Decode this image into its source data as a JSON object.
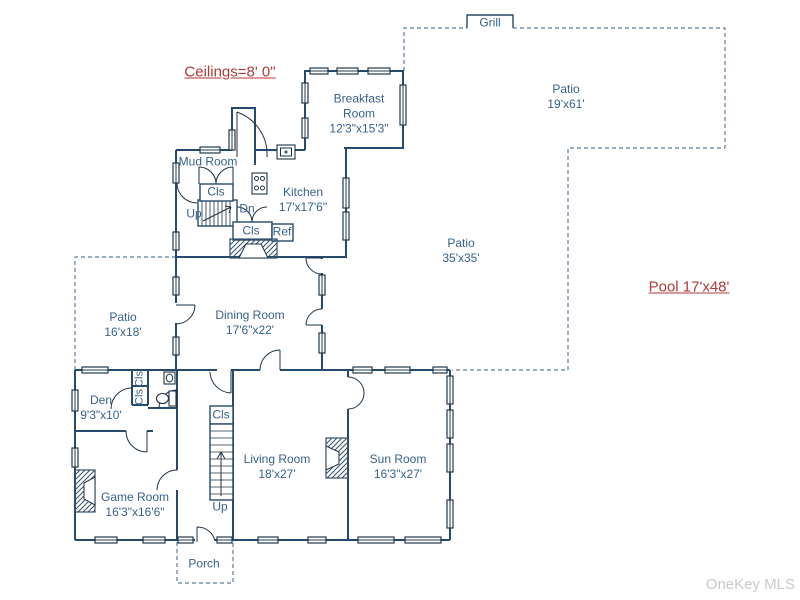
{
  "annotations": {
    "ceilings": "Ceilings=8' 0\"",
    "pool": "Pool 17'x48'"
  },
  "watermark": "OneKey MLS",
  "outdoor": {
    "grill": "Grill",
    "patio_upper": {
      "name": "Patio",
      "dims": "19'x61'"
    },
    "patio_courtyard": {
      "name": "Patio",
      "dims": "35'x35'"
    },
    "patio_side": {
      "name": "Patio",
      "dims": "16'x18'"
    },
    "porch": "Porch"
  },
  "rooms": {
    "breakfast": {
      "name_line1": "Breakfast",
      "name_line2": "Room",
      "dims": "12'3\"x15'3\""
    },
    "kitchen": {
      "name": "Kitchen",
      "dims": "17'x17'6\""
    },
    "mud": {
      "name": "Mud Room"
    },
    "dining": {
      "name": "Dining Room",
      "dims": "17'6\"x22'"
    },
    "den": {
      "name": "Den",
      "dims": "9'3\"x10'"
    },
    "game": {
      "name": "Game Room",
      "dims": "16'3\"x16'6\""
    },
    "living": {
      "name": "Living Room",
      "dims": "18'x27'"
    },
    "sun": {
      "name": "Sun Room",
      "dims": "16'3\"x27'"
    }
  },
  "fixtures": {
    "cls": "Cls",
    "ref": "Ref",
    "up": "Up",
    "dn": "Dn"
  },
  "colors": {
    "wall": "#264a6b",
    "label": "#39618c",
    "annotation": "#b03a3a",
    "dash": "#5f7d99",
    "watermark": "#c9c9c9"
  }
}
